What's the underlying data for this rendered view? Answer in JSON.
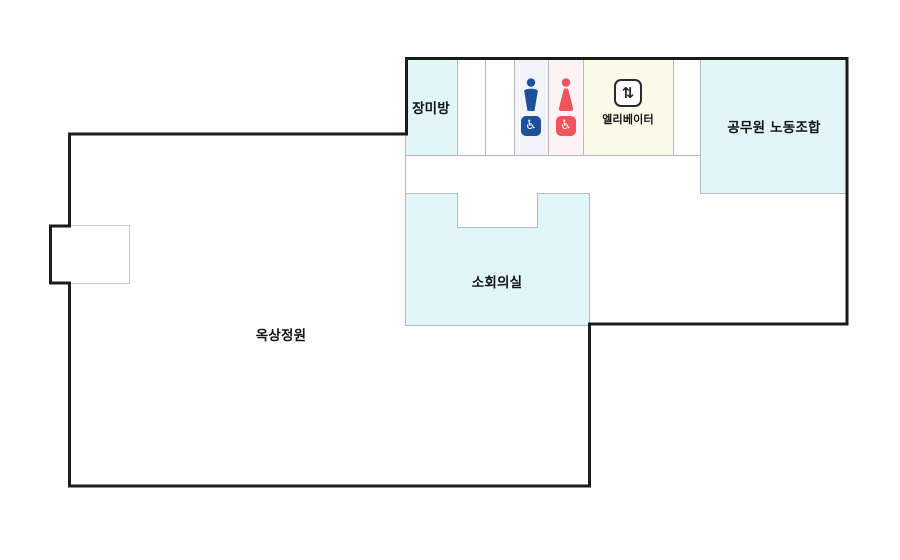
{
  "floor_plan": {
    "rooms": {
      "rose": {
        "label": "장미방",
        "fill": "#e1f6f9"
      },
      "union": {
        "label": "공무원 노동조합",
        "fill": "#e1f6f9"
      },
      "meeting": {
        "label": "소회의실",
        "fill": "#e1f6f9"
      },
      "garden": {
        "label": "옥상정원",
        "fill": "#ffffff"
      },
      "elevator": {
        "label": "엘리베이터",
        "fill": "#fcfbe9",
        "arrows_glyph": "⇅"
      }
    },
    "restrooms": {
      "male": {
        "color": "#1d4f9b",
        "fill": "#f2f4fa",
        "accessible_glyph": "♿"
      },
      "female": {
        "color": "#f2525c",
        "fill": "#fdf2f4",
        "accessible_glyph": "♿"
      }
    },
    "colors": {
      "outline_wall": "#1b1b1b",
      "partition_line": "#b4babe"
    }
  }
}
